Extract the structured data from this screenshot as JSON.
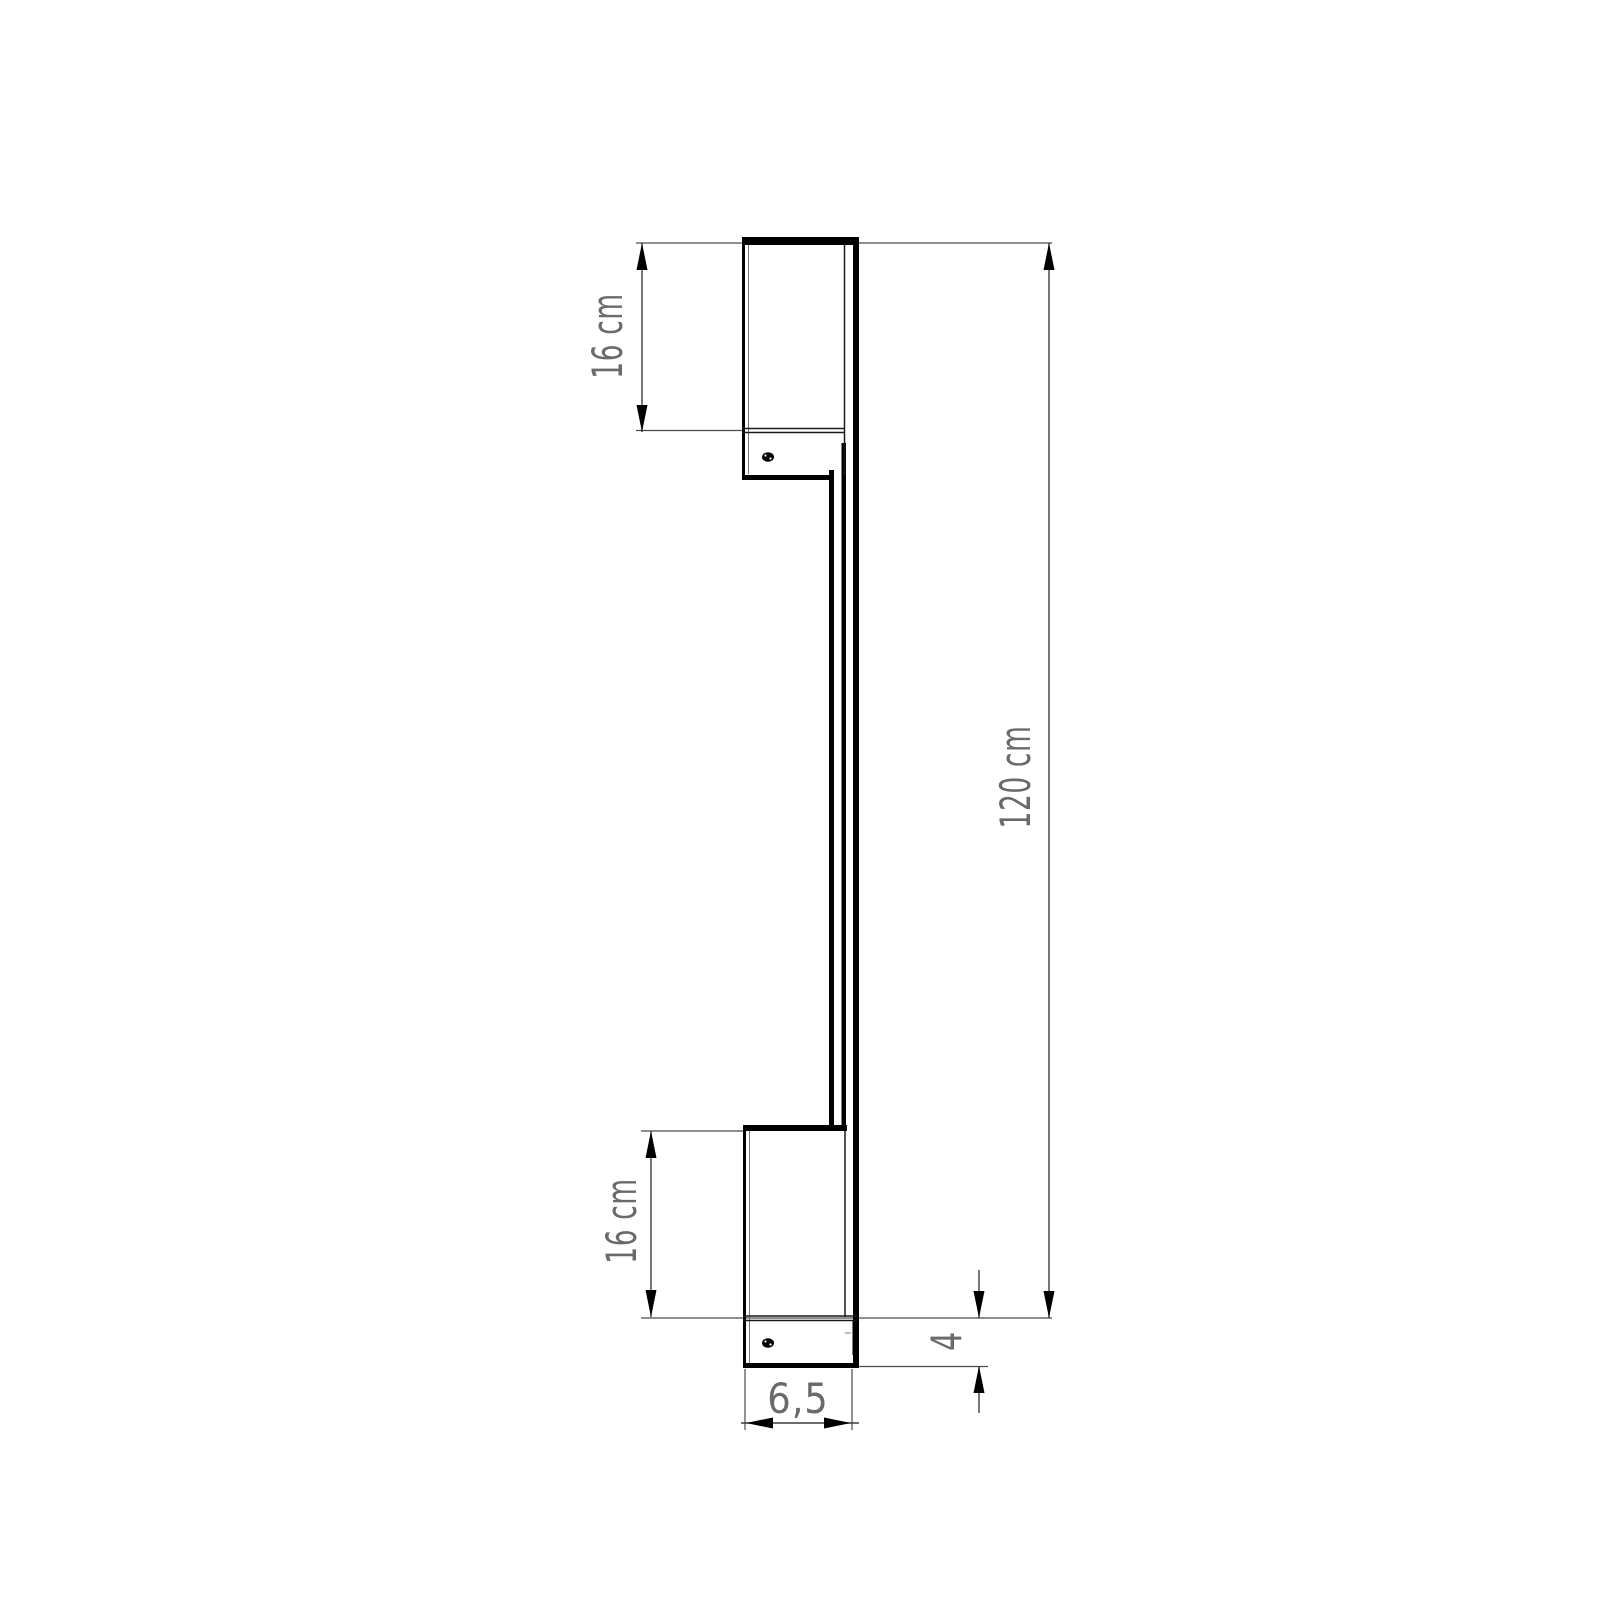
{
  "drawing": {
    "kind": "technical dimension drawing, side profile of wall-mounted linear lamp",
    "colors": {
      "background": "#ffffff",
      "fixture_line": "#000000",
      "dimension_line": "#3d3d3d",
      "label_text": "#6a6a6a"
    },
    "labels": {
      "bracket_top_height": "16 cm",
      "bracket_bottom_height": "16 cm",
      "total_height": "120 cm",
      "base_offset": "4",
      "base_width": "6,5"
    }
  }
}
